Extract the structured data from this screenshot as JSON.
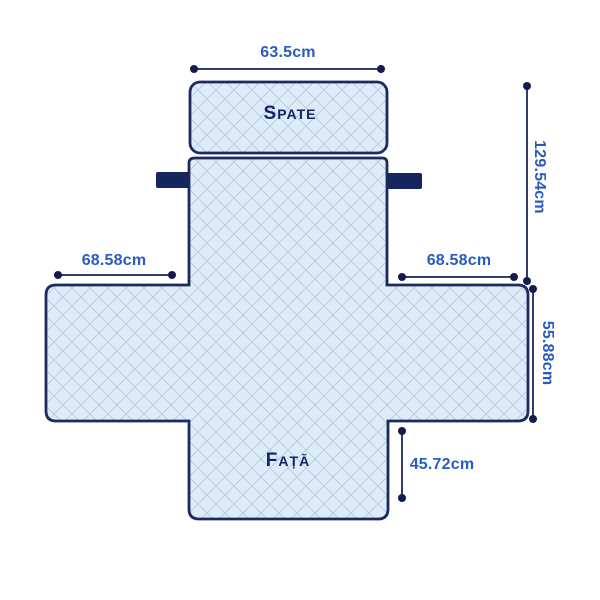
{
  "diagram": {
    "description": "Sofa cover dimension diagram (quilted armchair protector, cross-shaped layout)",
    "labels": {
      "back": "SPATE",
      "front": "FAȚĂ"
    },
    "dimensions": {
      "top_width": "63.5cm",
      "back_height": "129.54cm",
      "left_arm_width": "68.58cm",
      "right_arm_width": "68.58cm",
      "seat_side_height": "55.88cm",
      "front_height": "45.72cm"
    },
    "colors": {
      "outline": "#1c2a5e",
      "fabric": "#dcecf8",
      "lattice": "#aec3d6",
      "dim_line": "#333c6e",
      "dim_dot": "#141c4d",
      "dim_text": "#2a5cbf",
      "label_text": "#15246b",
      "strap": "#15265e",
      "background": "#ffffff"
    }
  }
}
